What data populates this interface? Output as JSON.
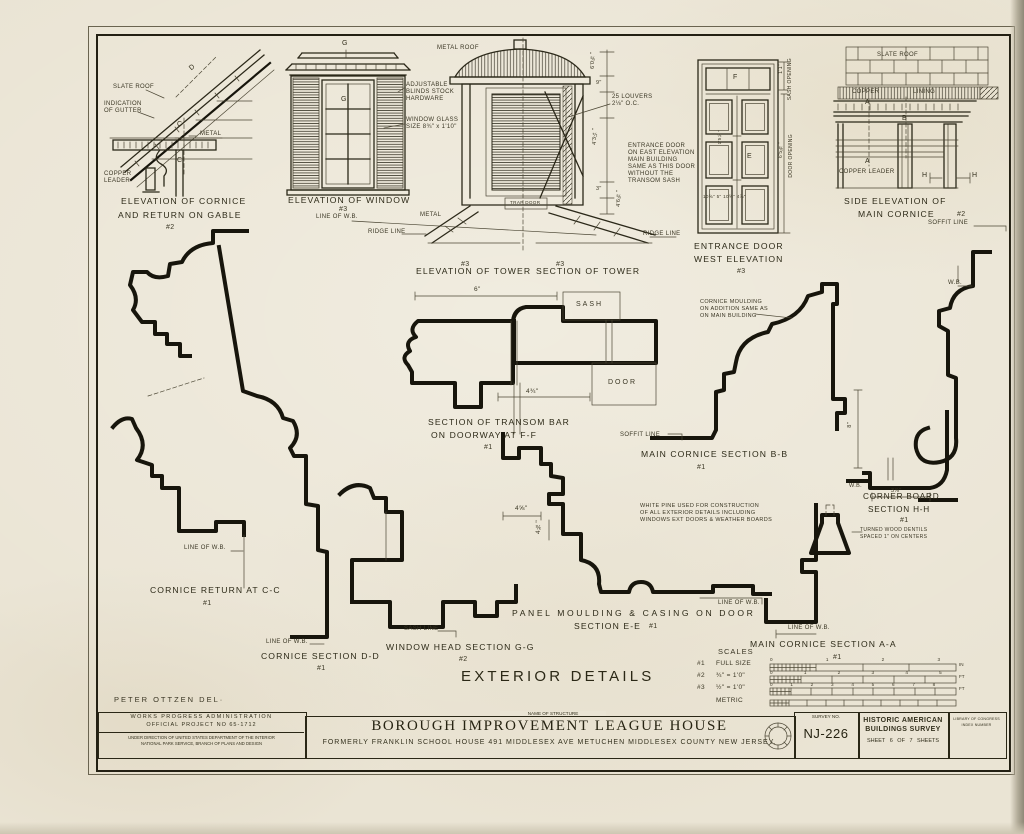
{
  "sheet": {
    "main_title": "EXTERIOR DETAILS",
    "delineator": "PETER OTTZEN DEL·"
  },
  "gable": {
    "caption1": "ELEVATION OF CORNICE",
    "caption2": "AND RETURN ON GABLE",
    "mark": "#2",
    "slate_roof": "SLATE ROOF",
    "gutter1": "INDICATION",
    "gutter2": "OF GUTTER",
    "metal": "METAL",
    "leader1": "COPPER",
    "leader2": "LEADER",
    "d": "D",
    "c": "C"
  },
  "window": {
    "caption": "ELEVATION OF WINDOW",
    "mark": "#3",
    "line_wb": "LINE OF W.B.",
    "blinds1": "ADJUSTABLE",
    "blinds2": "BLINDS STOCK",
    "blinds3": "HARDWARE",
    "glass1": "WINDOW GLASS",
    "glass2": "SIZE 8¾\" x 1'10\"",
    "g": "G"
  },
  "tower": {
    "metal_roof": "METAL ROOF",
    "metal": "METAL",
    "trap_door": "TRAP DOOR",
    "ridge_left": "RIDGE LINE",
    "ridge_right": "RIDGE LINE",
    "caption_left": "ELEVATION OF TOWER",
    "caption_right": "SECTION OF TOWER",
    "mark_left": "#3",
    "mark_right": "#3",
    "louvers1": "25 LOUVERS",
    "louvers2": "2⅛\" O.C.",
    "dim1": "6'0⅝\"",
    "dim2": "9\"",
    "dim3": "4'3¼\"",
    "dim4": "3\"",
    "dim5": "4'6⅝\"",
    "note0": "ENTRANCE DOOR",
    "note1": "ON EAST ELEVATION",
    "note2": "MAIN BUILDING",
    "note3": "SAME AS THIS DOOR",
    "note4": "WITHOUT THE",
    "note5": "TRANSOM SASH"
  },
  "door": {
    "caption1": "ENTRANCE DOOR",
    "caption2": "WEST ELEVATION",
    "mark": "#3",
    "sash_dim": "1'1\"",
    "sash_open": "SASH OPENING",
    "door_dim": "6'5⅜\"",
    "door_open": "DOOR OPENING",
    "f": "F",
    "e": "E",
    "mid_dim": "1'5½\"",
    "bottom_dims": "10⅝\" 5\" 10⅝\" 4⅞\""
  },
  "side_cornice": {
    "slate_roof": "SLATE ROOF",
    "copper": "COPPER",
    "lining": "LINING",
    "copper_leader": "COPPER LEADER",
    "a": "A",
    "b": "B",
    "h1": "H",
    "h2": "H",
    "caption1": "SIDE ELEVATION OF",
    "caption2": "MAIN CORNICE",
    "mark": "#2",
    "soffit": "SOFFIT LINE",
    "wb": "W.B."
  },
  "ff": {
    "caption1": "SECTION OF TRANSOM BAR",
    "caption2": "ON DOORWAY AT F-F",
    "mark": "#1",
    "sash": "SASH",
    "door": "DOOR",
    "dim6": "6\"",
    "dim434": "4¾\""
  },
  "cc": {
    "caption": "CORNICE RETURN AT C-C",
    "mark": "#1",
    "line_wb": "LINE OF W.B."
  },
  "bb": {
    "caption": "MAIN CORNICE SECTION B-B",
    "mark": "#1",
    "soffit": "SOFFIT LINE",
    "note0": "CORNICE MOULDING",
    "note1": "ON ADDITION SAME AS",
    "note2": "ON MAIN BUILDING"
  },
  "hh": {
    "caption1": "CORNER BOARD",
    "caption2": "SECTION H-H",
    "mark": "#1",
    "dim378": "3⅞\"",
    "dim8": "8\"",
    "wb": "W.B.",
    "note0": "TURNED WOOD DENTILS",
    "note1": "SPACED 1\" ON CENTERS"
  },
  "ee": {
    "caption1": "PANEL MOULDING & CASING ON DOOR",
    "caption2": "SECTION E-E",
    "mark": "#1",
    "dim458": "4⅝\"",
    "dim438": "4⅜\""
  },
  "gg": {
    "caption": "WINDOW HEAD SECTION G-G",
    "mark": "#2",
    "sash_line": "SASH LINE"
  },
  "dd": {
    "caption": "CORNICE SECTION D-D",
    "mark": "#1",
    "line_wb": "LINE OF W.B."
  },
  "aa": {
    "caption": "MAIN CORNICE SECTION A-A",
    "mark": "#1",
    "line_wb1": "LINE OF W.B.",
    "line_wb2": "LINE OF W.B."
  },
  "pine": {
    "note0": "WHITE PINE USED FOR CONSTRUCTION",
    "note1": "OF ALL EXTERIOR DETAILS INCLUDING",
    "note2": "WINDOWS EXT DOORS & WEATHER BOARDS"
  },
  "scales": {
    "title": "SCALES",
    "m1": "#1",
    "l1": "FULL SIZE",
    "t1": "0 1 2 3",
    "u1": "IN",
    "m2": "#2",
    "l2": "¾\" = 1'0\"",
    "t2": "0 1 2 3 4 5",
    "u2": "FT",
    "m3": "#3",
    "l3": "½\" = 1'0\"",
    "t3": "0 1 2 3 4 5 6 7 8",
    "u3": "FT",
    "l4": "METRIC"
  },
  "title_block": {
    "wpa1": "WORKS PROGRESS ADMINISTRATION",
    "wpa2": "OFFICIAL PROJECT NO 65-1712",
    "wpa3": "UNDER DIRECTION OF UNITED STATES DEPARTMENT OF THE INTERIOR",
    "wpa4": "NATIONAL PARK SERVICE, BRANCH OF PLANS AND DESIGN",
    "name_label": "NAME OF STRUCTURE",
    "name": "BOROUGH IMPROVEMENT LEAGUE HOUSE",
    "sub": "FORMERLY FRANKLIN SCHOOL HOUSE 491 MIDDLESEX AVE METUCHEN MIDDLESEX COUNTY NEW JERSEY.",
    "survey_label": "SURVEY NO.",
    "survey_no": "NJ-226",
    "habs1": "HISTORIC AMERICAN",
    "habs2": "BUILDINGS SURVEY",
    "sheet": "SHEET 6 OF 7 SHEETS",
    "loc1": "LIBRARY OF CONGRESS",
    "loc2": "INDEX NUMBER"
  }
}
